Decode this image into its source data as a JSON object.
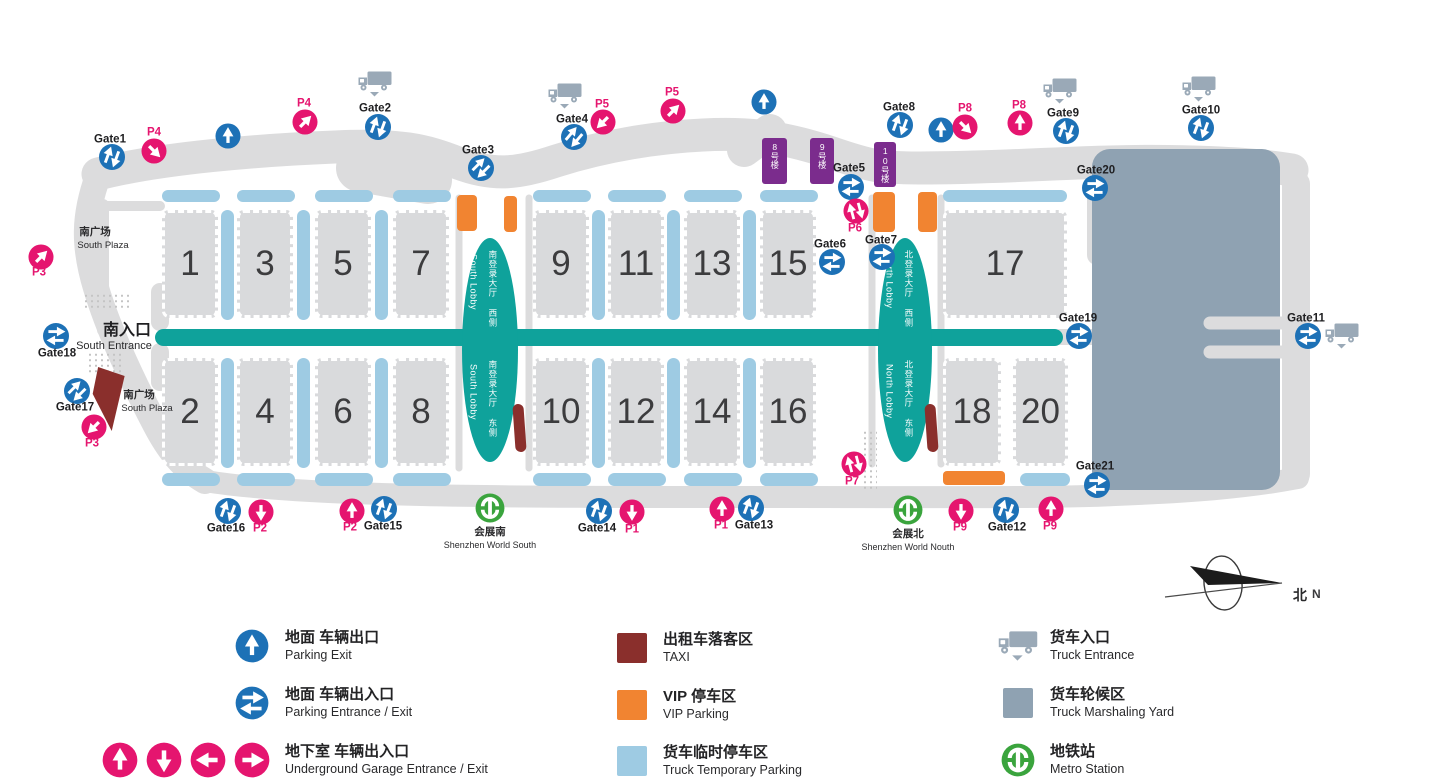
{
  "colors": {
    "teal": "#0fa29b",
    "light_blue": "#9ecbe3",
    "orange": "#f18431",
    "taxi_red": "#8a2f2c",
    "yard_gray_blue": "#8fa2b2",
    "purple": "#7b2c8d",
    "pink": "#e5156f",
    "blue": "#1d71b6",
    "metro_green": "#3aa43d",
    "road_gray": "#dcdcdd",
    "hall_gray": "#d9dadc"
  },
  "map": {
    "entrance": {
      "zh": "南入口",
      "en": "South Entrance"
    },
    "plazas": [
      {
        "zh": "南广场",
        "en": "South Plaza",
        "x": 79,
        "y": 228
      },
      {
        "zh": "南广场",
        "en": "South Plaza",
        "x": 123,
        "y": 391
      }
    ],
    "halls": [
      {
        "n": "1",
        "x": 162,
        "y": 210,
        "w": 56,
        "h": 108
      },
      {
        "n": "3",
        "x": 237,
        "y": 210,
        "w": 56,
        "h": 108
      },
      {
        "n": "5",
        "x": 315,
        "y": 210,
        "w": 56,
        "h": 108
      },
      {
        "n": "7",
        "x": 393,
        "y": 210,
        "w": 56,
        "h": 108
      },
      {
        "n": "9",
        "x": 533,
        "y": 210,
        "w": 56,
        "h": 108
      },
      {
        "n": "11",
        "x": 608,
        "y": 210,
        "w": 56,
        "h": 108
      },
      {
        "n": "13",
        "x": 684,
        "y": 210,
        "w": 56,
        "h": 108
      },
      {
        "n": "15",
        "x": 760,
        "y": 210,
        "w": 56,
        "h": 108
      },
      {
        "n": "17",
        "x": 943,
        "y": 210,
        "w": 124,
        "h": 108
      },
      {
        "n": "2",
        "x": 162,
        "y": 358,
        "w": 56,
        "h": 108
      },
      {
        "n": "4",
        "x": 237,
        "y": 358,
        "w": 56,
        "h": 108
      },
      {
        "n": "6",
        "x": 315,
        "y": 358,
        "w": 56,
        "h": 108
      },
      {
        "n": "8",
        "x": 393,
        "y": 358,
        "w": 56,
        "h": 108
      },
      {
        "n": "10",
        "x": 533,
        "y": 358,
        "w": 56,
        "h": 108
      },
      {
        "n": "12",
        "x": 608,
        "y": 358,
        "w": 56,
        "h": 108
      },
      {
        "n": "14",
        "x": 684,
        "y": 358,
        "w": 56,
        "h": 108
      },
      {
        "n": "16",
        "x": 760,
        "y": 358,
        "w": 56,
        "h": 108
      },
      {
        "n": "18",
        "x": 943,
        "y": 358,
        "w": 58,
        "h": 108
      },
      {
        "n": "20",
        "x": 1013,
        "y": 358,
        "w": 55,
        "h": 108
      }
    ],
    "buildings": [
      {
        "label": "8号楼",
        "x": 762,
        "y": 138,
        "w": 25,
        "h": 46
      },
      {
        "label": "9号楼",
        "x": 810,
        "y": 138,
        "w": 24,
        "h": 46
      },
      {
        "label": "10号楼",
        "x": 874,
        "y": 142,
        "w": 22,
        "h": 45
      }
    ],
    "lobbies": [
      {
        "x": 462,
        "y": 238,
        "w": 56,
        "h": 224,
        "top_zh": "南登录大厅 西侧",
        "top_en": "South Lobby",
        "bottom_zh": "南登录大厅 东侧",
        "bottom_en": "South Lobby"
      },
      {
        "x": 878,
        "y": 238,
        "w": 54,
        "h": 224,
        "top_zh": "北登录大厅 西侧",
        "top_en": "North Lobby",
        "bottom_zh": "北登录大厅 东侧",
        "bottom_en": "North Lobby"
      }
    ],
    "markers": [
      {
        "kind": "gate",
        "label": "Gate1",
        "x": 112,
        "y": 157,
        "rot": 20,
        "lx": 110,
        "ly": 140
      },
      {
        "kind": "gate",
        "label": "Gate2",
        "x": 378,
        "y": 127,
        "rot": 20,
        "lx": 375,
        "ly": 109
      },
      {
        "kind": "gate",
        "label": "Gate3",
        "x": 481,
        "y": 168,
        "rot": 45,
        "lx": 478,
        "ly": 151
      },
      {
        "kind": "gate",
        "label": "Gate4",
        "x": 574,
        "y": 137,
        "rot": 40,
        "lx": 572,
        "ly": 120
      },
      {
        "kind": "gate",
        "label": "Gate5",
        "x": 851,
        "y": 187,
        "rot": 90,
        "lx": 849,
        "ly": 169
      },
      {
        "kind": "gate",
        "label": "Gate6",
        "x": 832,
        "y": 262,
        "rot": 90,
        "lx": 830,
        "ly": 245
      },
      {
        "kind": "gate",
        "label": "Gate7",
        "x": 882,
        "y": 257,
        "rot": 90,
        "lx": 881,
        "ly": 241
      },
      {
        "kind": "gate",
        "label": "Gate8",
        "x": 900,
        "y": 125,
        "rot": 20,
        "lx": 899,
        "ly": 108
      },
      {
        "kind": "gate",
        "label": "Gate9",
        "x": 1066,
        "y": 131,
        "rot": 20,
        "lx": 1063,
        "ly": 114
      },
      {
        "kind": "gate",
        "label": "Gate10",
        "x": 1201,
        "y": 128,
        "rot": 20,
        "lx": 1201,
        "ly": 111
      },
      {
        "kind": "gate",
        "label": "Gate11",
        "x": 1308,
        "y": 336,
        "rot": 90,
        "lx": 1306,
        "ly": 319
      },
      {
        "kind": "gate",
        "label": "Gate12",
        "x": 1006,
        "y": 510,
        "rot": 20,
        "lx": 1007,
        "ly": 528
      },
      {
        "kind": "gate",
        "label": "Gate13",
        "x": 751,
        "y": 508,
        "rot": 20,
        "lx": 754,
        "ly": 526
      },
      {
        "kind": "gate",
        "label": "Gate14",
        "x": 599,
        "y": 511,
        "rot": 20,
        "lx": 597,
        "ly": 529
      },
      {
        "kind": "gate",
        "label": "Gate15",
        "x": 384,
        "y": 509,
        "rot": 20,
        "lx": 383,
        "ly": 527
      },
      {
        "kind": "gate",
        "label": "Gate16",
        "x": 228,
        "y": 511,
        "rot": 20,
        "lx": 226,
        "ly": 529
      },
      {
        "kind": "gate",
        "label": "Gate17",
        "x": 77,
        "y": 391,
        "rot": 45,
        "lx": 75,
        "ly": 408
      },
      {
        "kind": "gate",
        "label": "Gate18",
        "x": 56,
        "y": 336,
        "rot": 90,
        "lx": 57,
        "ly": 354
      },
      {
        "kind": "gate",
        "label": "Gate19",
        "x": 1079,
        "y": 336,
        "rot": 90,
        "lx": 1078,
        "ly": 319
      },
      {
        "kind": "gate",
        "label": "Gate20",
        "x": 1095,
        "y": 188,
        "rot": 90,
        "lx": 1096,
        "ly": 171
      },
      {
        "kind": "gate",
        "label": "Gate21",
        "x": 1097,
        "y": 485,
        "rot": 90,
        "lx": 1095,
        "ly": 467
      },
      {
        "kind": "exit",
        "x": 228,
        "y": 136
      },
      {
        "kind": "exit",
        "x": 764,
        "y": 102
      },
      {
        "kind": "exit",
        "x": 941,
        "y": 130
      },
      {
        "kind": "p",
        "label": "P4",
        "dir": "se",
        "x": 154,
        "y": 151,
        "lx": 154,
        "ly": 133
      },
      {
        "kind": "p",
        "label": "P4",
        "dir": "ne",
        "x": 305,
        "y": 122,
        "lx": 304,
        "ly": 104
      },
      {
        "kind": "p",
        "label": "P3",
        "dir": "ne",
        "x": 41,
        "y": 257,
        "lx": 39,
        "ly": 273
      },
      {
        "kind": "p",
        "label": "P3",
        "dir": "sw",
        "x": 94,
        "y": 427,
        "lx": 92,
        "ly": 444
      },
      {
        "kind": "p",
        "label": "P5",
        "dir": "sw",
        "x": 603,
        "y": 122,
        "lx": 602,
        "ly": 105
      },
      {
        "kind": "p",
        "label": "P5",
        "dir": "ne",
        "x": 673,
        "y": 111,
        "lx": 672,
        "ly": 93
      },
      {
        "kind": "pee",
        "label": "P6",
        "x": 856,
        "y": 211,
        "lx": 855,
        "ly": 229
      },
      {
        "kind": "pee",
        "label": "P7",
        "x": 854,
        "y": 464,
        "lx": 852,
        "ly": 482
      },
      {
        "kind": "p",
        "label": "P8",
        "dir": "se",
        "x": 965,
        "y": 127,
        "lx": 965,
        "ly": 109
      },
      {
        "kind": "p",
        "label": "P8",
        "dir": "up",
        "x": 1020,
        "y": 123,
        "lx": 1019,
        "ly": 106
      },
      {
        "kind": "p",
        "label": "P2",
        "dir": "down",
        "x": 261,
        "y": 512,
        "lx": 260,
        "ly": 529
      },
      {
        "kind": "p",
        "label": "P2",
        "dir": "up",
        "x": 352,
        "y": 511,
        "lx": 350,
        "ly": 528
      },
      {
        "kind": "p",
        "label": "P1",
        "dir": "down",
        "x": 632,
        "y": 512,
        "lx": 632,
        "ly": 530
      },
      {
        "kind": "p",
        "label": "P1",
        "dir": "up",
        "x": 722,
        "y": 509,
        "lx": 721,
        "ly": 526
      },
      {
        "kind": "p",
        "label": "P9",
        "dir": "down",
        "x": 961,
        "y": 511,
        "lx": 960,
        "ly": 528
      },
      {
        "kind": "p",
        "label": "P9",
        "dir": "up",
        "x": 1051,
        "y": 509,
        "lx": 1050,
        "ly": 527
      },
      {
        "kind": "truck",
        "x": 375,
        "y": 84
      },
      {
        "kind": "truck",
        "x": 565,
        "y": 96
      },
      {
        "kind": "truck",
        "x": 1060,
        "y": 91
      },
      {
        "kind": "truck",
        "x": 1199,
        "y": 89
      },
      {
        "kind": "truck",
        "x": 1342,
        "y": 336
      },
      {
        "kind": "metro",
        "zh": "会展南",
        "en": "Shenzhen World South",
        "x": 490,
        "y": 508
      },
      {
        "kind": "metro",
        "zh": "会展北",
        "en": "Shenzhen World Nouth",
        "x": 908,
        "y": 510
      }
    ],
    "compass": {
      "zh": "北",
      "en": "N"
    }
  },
  "legend": {
    "items": [
      {
        "icon": "blue-exit",
        "zh": "地面 车辆出口",
        "en": "Parking Exit",
        "icon_x": 252,
        "text_x": 285,
        "y": 646
      },
      {
        "icon": "blue-ee",
        "zh": "地面 车辆出入口",
        "en": "Parking Entrance / Exit",
        "icon_x": 252,
        "text_x": 285,
        "y": 703
      },
      {
        "icon": "pink-4",
        "zh": "地下室 车辆出入口",
        "en": "Underground Garage Entrance / Exit",
        "icon_x": 252,
        "text_x": 285,
        "y": 760
      },
      {
        "icon": "taxi-swatch",
        "zh": "出租车落客区",
        "en": "TAXI",
        "icon_x": 632,
        "text_x": 663,
        "y": 648
      },
      {
        "icon": "vip-swatch",
        "zh": "VIP 停车区",
        "en": "VIP Parking",
        "icon_x": 632,
        "text_x": 663,
        "y": 705
      },
      {
        "icon": "truckpark-swatch",
        "zh": "货车临时停车区",
        "en": "Truck Temporary Parking",
        "icon_x": 632,
        "text_x": 663,
        "y": 761
      },
      {
        "icon": "truck",
        "zh": "货车入口",
        "en": "Truck Entrance",
        "icon_x": 1018,
        "text_x": 1050,
        "y": 646
      },
      {
        "icon": "yard-swatch",
        "zh": "货车轮候区",
        "en": "Truck Marshaling Yard",
        "icon_x": 1018,
        "text_x": 1050,
        "y": 703
      },
      {
        "icon": "metro",
        "zh": "地铁站",
        "en": "Metro Station",
        "icon_x": 1018,
        "text_x": 1050,
        "y": 760
      }
    ]
  }
}
